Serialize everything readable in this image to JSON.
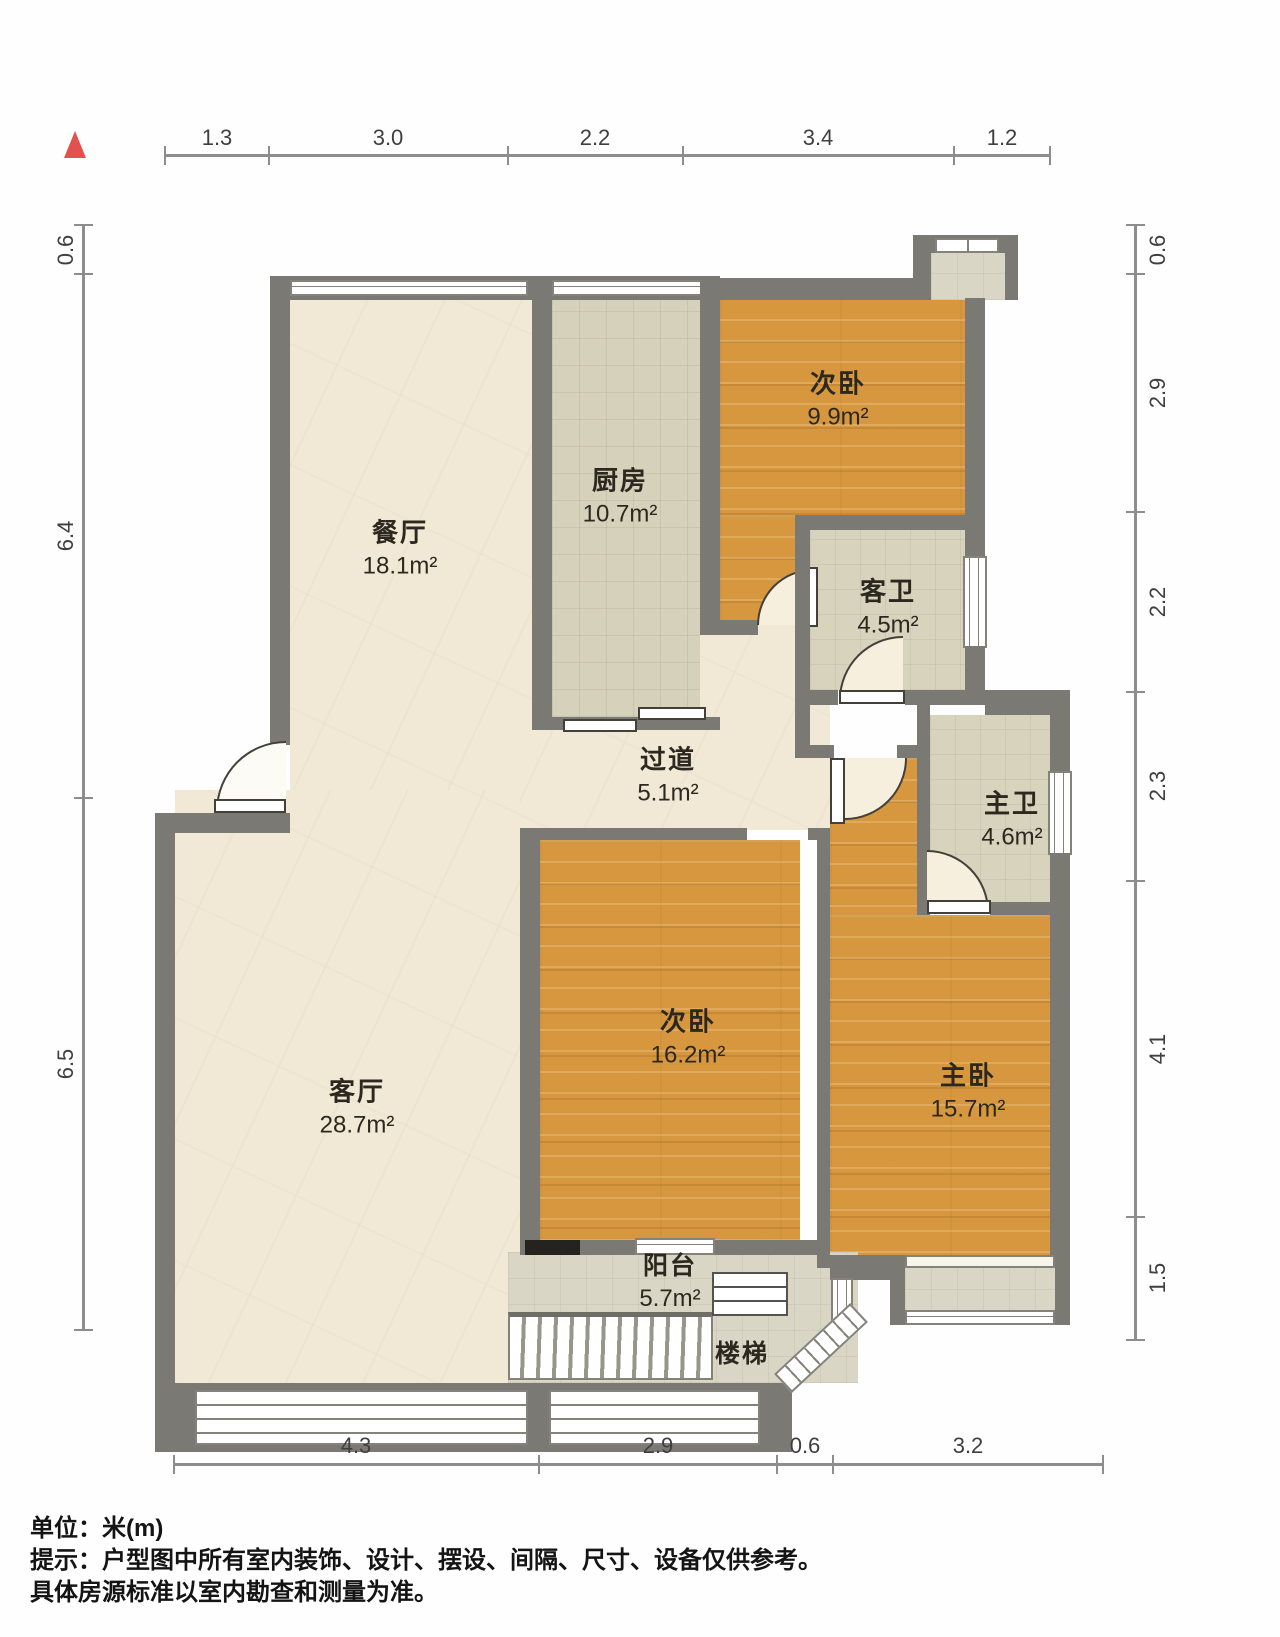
{
  "legend": {
    "north": "north-indicator"
  },
  "rooms": {
    "dining": {
      "name": "餐厅",
      "area": "18.1m²"
    },
    "kitchen": {
      "name": "厨房",
      "area": "10.7m²"
    },
    "bedroom_top": {
      "name": "次卧",
      "area": "9.9m²"
    },
    "guest_bath": {
      "name": "客卫",
      "area": "4.5m²"
    },
    "hallway": {
      "name": "过道",
      "area": "5.1m²"
    },
    "master_bath": {
      "name": "主卫",
      "area": "4.6m²"
    },
    "bedroom_mid": {
      "name": "次卧",
      "area": "16.2m²"
    },
    "master": {
      "name": "主卧",
      "area": "15.7m²"
    },
    "living": {
      "name": "客厅",
      "area": "28.7m²"
    },
    "balcony": {
      "name": "阳台",
      "area": "5.7m²"
    },
    "stairs": {
      "name": "楼梯"
    }
  },
  "dimensions": {
    "top": [
      "1.3",
      "3.0",
      "2.2",
      "3.4",
      "1.2"
    ],
    "left": [
      "0.6",
      "6.4",
      "6.5"
    ],
    "right": [
      "0.6",
      "2.9",
      "2.2",
      "2.3",
      "4.1",
      "1.5"
    ],
    "bottom": [
      "4.3",
      "2.9",
      "0.6",
      "3.2"
    ]
  },
  "notes": {
    "unit": "单位：米(m)",
    "tip_line1": "提示：户型图中所有室内装饰、设计、摆设、间隔、尺寸、设备仅供参考。",
    "tip_line2": "具体房源标准以室内勘查和测量为准。"
  },
  "colors": {
    "wall": "#7b7974",
    "wood_floor": "#d6973e",
    "cream_floor": "#f1e8d5",
    "tile_floor": "#d8d3bd",
    "north_marker": "#e0514f"
  }
}
